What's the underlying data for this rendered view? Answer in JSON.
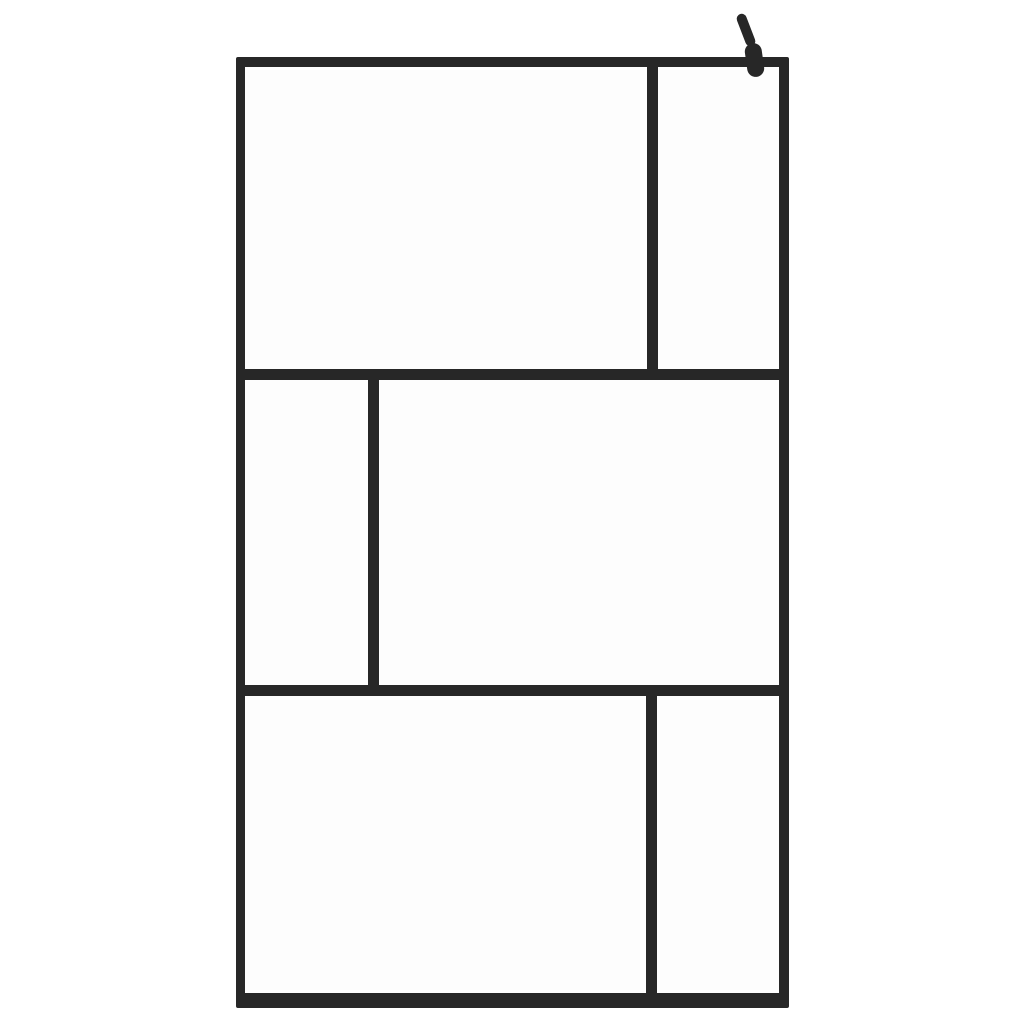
{
  "canvas": {
    "width": 1024,
    "height": 1024,
    "background_color": "#ffffff"
  },
  "product": {
    "id": "walk-in-shower-screen-black-frame",
    "frame_color": "#272727",
    "glass_color": "#fdfdfd",
    "outer_frame": {
      "x": 236,
      "y": 57,
      "width": 553,
      "height": 951,
      "border_top": 10,
      "border_right": 10,
      "border_bottom": 15,
      "border_left": 9
    },
    "mullions": [
      {
        "id": "mullion-horizontal-upper",
        "x": 236,
        "y": 369,
        "width": 553,
        "height": 11
      },
      {
        "id": "mullion-horizontal-lower",
        "x": 236,
        "y": 685,
        "width": 553,
        "height": 11
      },
      {
        "id": "mullion-vertical-top-band",
        "x": 647,
        "y": 57,
        "width": 11,
        "height": 323
      },
      {
        "id": "mullion-vertical-middle-band",
        "x": 368,
        "y": 369,
        "width": 11,
        "height": 327
      },
      {
        "id": "mullion-vertical-bottom-band",
        "x": 646,
        "y": 685,
        "width": 11,
        "height": 323
      }
    ],
    "glass_panes": [
      {
        "id": "glass-pane-top-left",
        "x": 245,
        "y": 67,
        "width": 402,
        "height": 302
      },
      {
        "id": "glass-pane-top-right",
        "x": 658,
        "y": 67,
        "width": 121,
        "height": 302
      },
      {
        "id": "glass-pane-middle-left",
        "x": 245,
        "y": 380,
        "width": 123,
        "height": 305
      },
      {
        "id": "glass-pane-middle-right",
        "x": 379,
        "y": 380,
        "width": 400,
        "height": 305
      },
      {
        "id": "glass-pane-bottom-left",
        "x": 245,
        "y": 696,
        "width": 401,
        "height": 297
      },
      {
        "id": "glass-pane-bottom-right",
        "x": 657,
        "y": 696,
        "width": 122,
        "height": 297
      }
    ],
    "wall_bracket": {
      "arm": {
        "x": 741,
        "y": 13,
        "width": 10,
        "height": 34,
        "rotate_deg": -21
      },
      "clamp": {
        "x": 746,
        "y": 43,
        "width": 17,
        "height": 34,
        "rotate_deg": -8
      }
    }
  }
}
